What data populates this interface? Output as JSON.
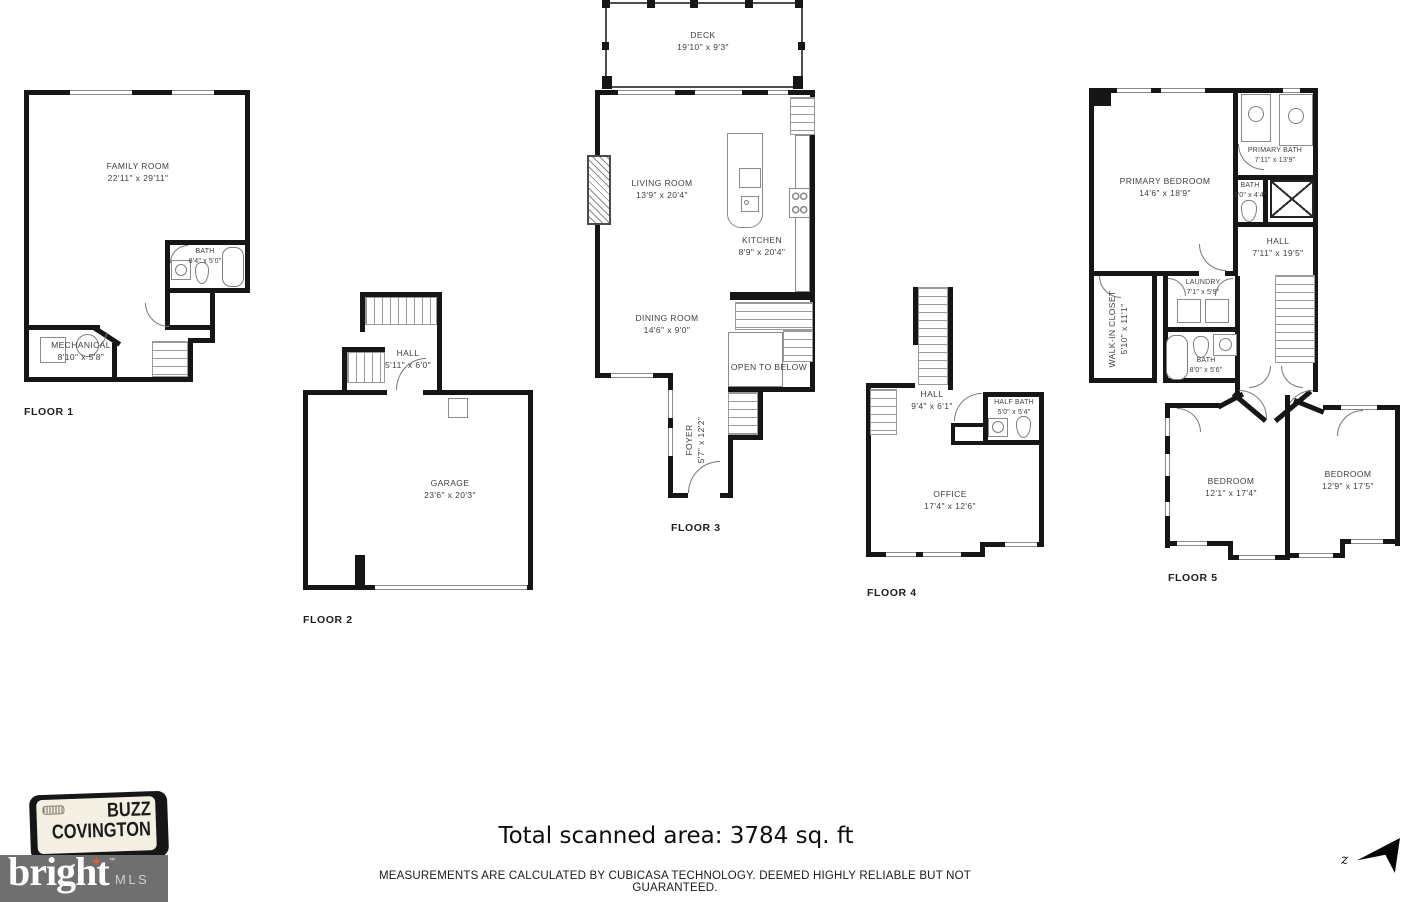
{
  "floors": [
    {
      "label": "FLOOR 1",
      "rooms": [
        {
          "name": "FAMILY ROOM",
          "dims": "22'11\" x 29'11\""
        },
        {
          "name": "BATH",
          "dims": "8'4\" x 5'0\""
        },
        {
          "name": "MECHANICAL",
          "dims": "8'10\" x 5'8\""
        }
      ]
    },
    {
      "label": "FLOOR 2",
      "rooms": [
        {
          "name": "HALL",
          "dims": "5'11\" x 6'0\""
        },
        {
          "name": "GARAGE",
          "dims": "23'6\" x 20'3\""
        }
      ]
    },
    {
      "label": "FLOOR 3",
      "rooms": [
        {
          "name": "DECK",
          "dims": "19'10\" x 9'3\""
        },
        {
          "name": "LIVING ROOM",
          "dims": "13'9\" x 20'4\""
        },
        {
          "name": "KITCHEN",
          "dims": "8'9\" x 20'4\""
        },
        {
          "name": "DINING ROOM",
          "dims": "14'6\" x 9'0\""
        },
        {
          "name": "OPEN TO BELOW",
          "dims": ""
        },
        {
          "name": "FOYER",
          "dims": "5'7\" x 12'2\""
        }
      ]
    },
    {
      "label": "FLOOR 4",
      "rooms": [
        {
          "name": "HALL",
          "dims": "9'4\" x 6'1\""
        },
        {
          "name": "HALF BATH",
          "dims": "5'0\" x 5'4\""
        },
        {
          "name": "OFFICE",
          "dims": "17'4\" x 12'6\""
        }
      ]
    },
    {
      "label": "FLOOR 5",
      "rooms": [
        {
          "name": "PRIMARY BEDROOM",
          "dims": "14'6\" x 18'9\""
        },
        {
          "name": "PRIMARY BATH",
          "dims": "7'11\" x 13'9\""
        },
        {
          "name": "BATH",
          "dims": "3'0\" x 4'4\""
        },
        {
          "name": "HALL",
          "dims": "7'11\" x 19'5\""
        },
        {
          "name": "WALK-IN CLOSET",
          "dims": "5'10\" x 11'1\""
        },
        {
          "name": "LAUNDRY",
          "dims": "7'1\" x 5'9\""
        },
        {
          "name": "BATH",
          "dims": "8'0\" x 5'6\""
        },
        {
          "name": "BEDROOM",
          "dims": "12'1\" x 17'4\""
        },
        {
          "name": "BEDROOM",
          "dims": "12'9\" x 17'5\""
        }
      ]
    }
  ],
  "footer": {
    "total_area": "Total scanned area: 3784 sq. ft",
    "disclaimer": "MEASUREMENTS ARE CALCULATED BY CUBICASA TECHNOLOGY. DEEMED HIGHLY RELIABLE BUT NOT GUARANTEED."
  },
  "branding": {
    "agent_line1": "BUZZ",
    "agent_line2": "COVINGTON",
    "mls_word": "bright",
    "mls_tm": "™",
    "mls_suffix": "MLS",
    "mls_bar_color": "#6f6f6f",
    "star_glyph": "✦",
    "star_color": "#e05c38"
  },
  "compass": {
    "letter": "z"
  }
}
